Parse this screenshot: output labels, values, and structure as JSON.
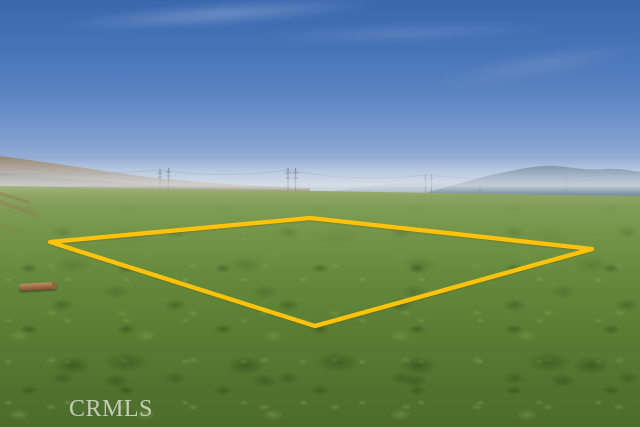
{
  "photo": {
    "watermark_text": "CRMLS",
    "watermark_color": "rgba(231,229,221,0.78)"
  },
  "parcel_boundary": {
    "color": "#FFC30B",
    "points": "50,242 310,218 592,249 315,326"
  },
  "palette": {
    "sky_top": "#3a67ae",
    "sky_horizon": "#c2cfe2",
    "haze": "#e2e6e6",
    "mountain_left_tan": "#9a8c79",
    "mountain_right_blue": "#68809e",
    "mountain_far_pale": "#92a5bf",
    "field_far_green": "#8ca465",
    "field_near_green": "#4c6c2c",
    "log_brown": "#a5714a",
    "tower_gray": "#46505f"
  }
}
